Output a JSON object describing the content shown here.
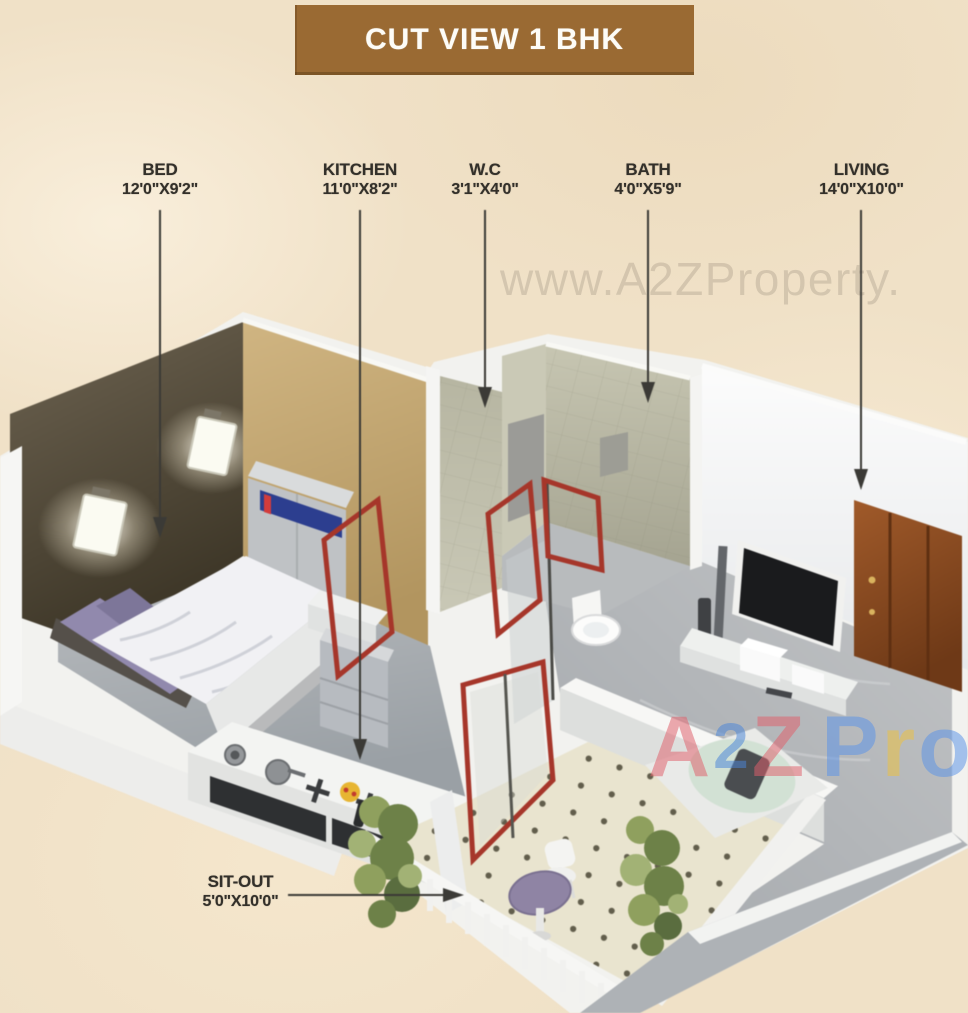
{
  "banner": {
    "title": "CUT VIEW 1 BHK",
    "bg_color": "#9a6a33",
    "text_color": "#fdfcf7"
  },
  "labels": [
    {
      "id": "bed",
      "name": "BED",
      "dims": "12'0\"X9'2\""
    },
    {
      "id": "kitchen",
      "name": "KITCHEN",
      "dims": "11'0\"X8'2\""
    },
    {
      "id": "wc",
      "name": "W.C",
      "dims": "3'1\"X4'0\""
    },
    {
      "id": "bath",
      "name": "BATH",
      "dims": "4'0\"X5'9\""
    },
    {
      "id": "living",
      "name": "LIVING",
      "dims": "14'0\"X10'0\""
    },
    {
      "id": "sitout",
      "name": "SIT-OUT",
      "dims": "5'0\"X10'0\""
    }
  ],
  "watermarks": {
    "top": "www.A2ZProperty.",
    "colored": [
      {
        "char": "A",
        "color": "#e0606b"
      },
      {
        "char": "2",
        "color": "#4a85d8"
      },
      {
        "char": "Z",
        "color": "#e0606b"
      },
      {
        "char": "P",
        "color": "#5b93e8"
      },
      {
        "char": "r",
        "color": "#eec23e"
      },
      {
        "char": "o",
        "color": "#5b93e8"
      },
      {
        "char": "p",
        "color": "#eec23e"
      }
    ]
  },
  "colors": {
    "background": "#f0e1c7",
    "label_text": "#33302a",
    "arrow": "#3b3a36",
    "red_door_frame": "#a6362a",
    "bedroom_wall": "#4c4434",
    "tan_wall": "#c3a877",
    "tile_wall": "#bcbba7",
    "entrance_door": "#8a4a22",
    "sitout_table": "#8f84a4",
    "sitout_floor": "#e9e4cf"
  }
}
